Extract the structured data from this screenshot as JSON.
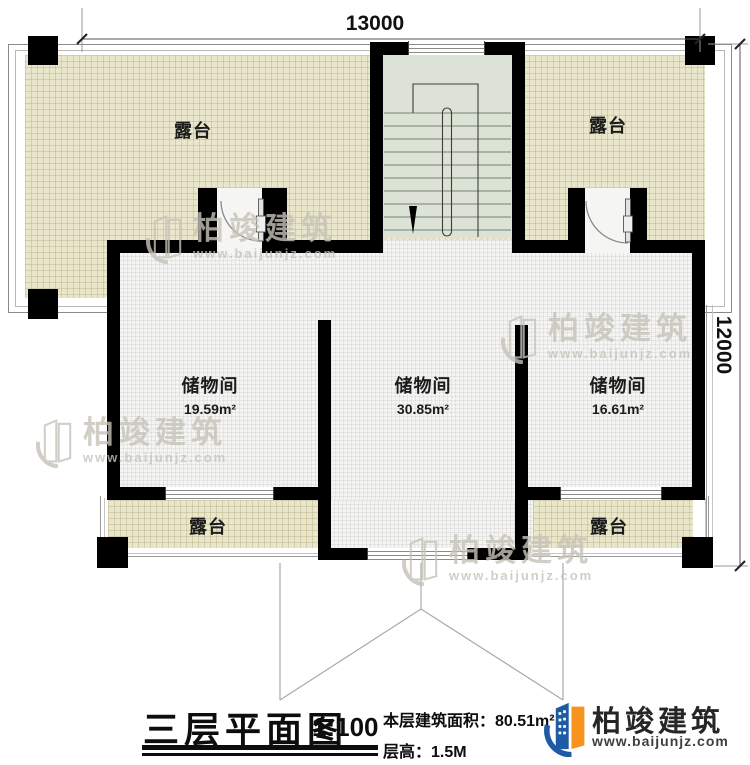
{
  "dimensions": {
    "top": "13000",
    "right": "12000"
  },
  "rooms": {
    "terrace_top_left": "露台",
    "terrace_top_right": "露台",
    "terrace_bottom_left": "露台",
    "terrace_bottom_right": "露台",
    "storage_left": {
      "name": "储物间",
      "area": "19.59m²"
    },
    "storage_middle": {
      "name": "储物间",
      "area": "30.85m²"
    },
    "storage_right": {
      "name": "储物间",
      "area": "16.61m²"
    }
  },
  "title_block": {
    "title": "三层平面图",
    "scale": "1:100",
    "area_label": "本层建筑面积：",
    "area_value": "80.51m²",
    "height_label": "层高：",
    "height_value": "1.5M"
  },
  "brand": {
    "name": "柏竣建筑",
    "website": "www.baijunjz.com"
  },
  "watermark": {
    "name": "柏竣建筑",
    "website": "www.baijunjz.com"
  },
  "colors": {
    "wall": "#000000",
    "terrace_fill": "#eae6cc",
    "room_fill": "#f4f4f2",
    "stair_fill": "#dce3d6",
    "logo_blue": "#1d5ba4",
    "logo_orange": "#f7941d"
  }
}
